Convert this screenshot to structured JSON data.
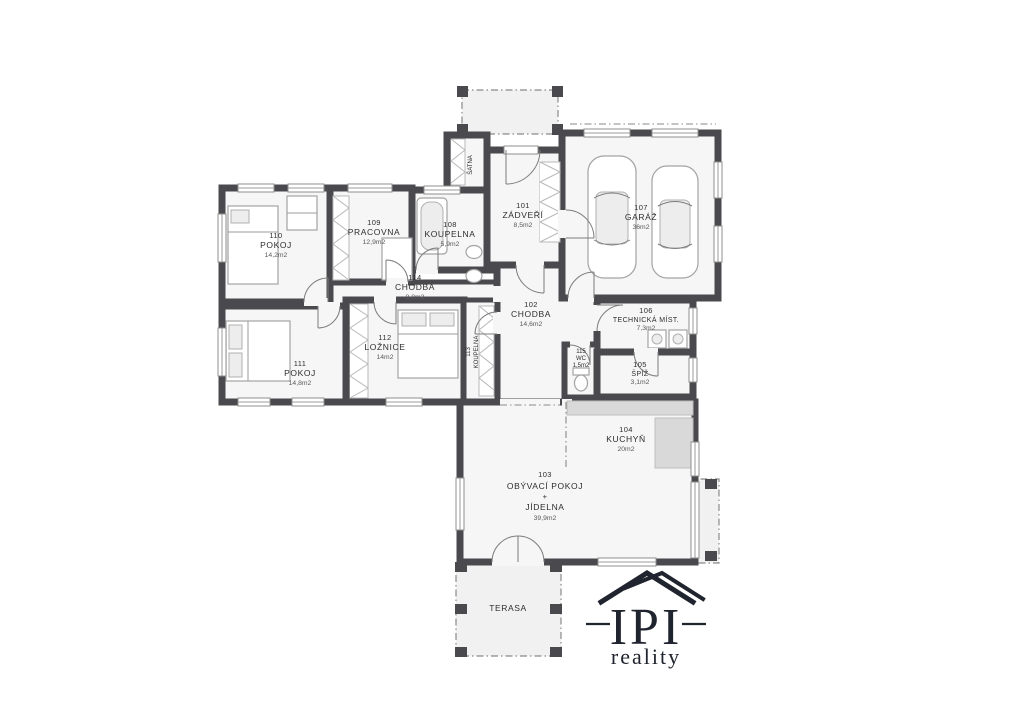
{
  "colors": {
    "wall": "#4a4a4e",
    "room_fill": "#f6f6f6",
    "label_text": "#2e2e2e",
    "logo": "#20242e"
  },
  "rooms": {
    "r101": {
      "number": "101",
      "name": "ZÁDVEŘÍ",
      "area": "8,5m2"
    },
    "r102": {
      "number": "102",
      "name": "CHODBA",
      "area": "14,6m2"
    },
    "r103": {
      "number": "103",
      "name": "OBÝVACÍ POKOJ",
      "plus": "+",
      "name2": "JÍDELNA",
      "area": "39,9m2"
    },
    "r104": {
      "number": "104",
      "name": "KUCHYŇ",
      "area": "20m2"
    },
    "r105": {
      "number": "105",
      "name": "ŠPÍŽ",
      "area": "3,1m2"
    },
    "r106": {
      "number": "106",
      "name": "TECHNICKÁ MÍST.",
      "area": "7,3m2"
    },
    "r107": {
      "number": "107",
      "name": "GARÁŽ",
      "area": "36m2"
    },
    "r108": {
      "number": "108",
      "name": "KOUPELNA",
      "area": "5,9m2"
    },
    "r109": {
      "number": "109",
      "name": "PRACOVNA",
      "area": "12,9m2"
    },
    "r110": {
      "number": "110",
      "name": "POKOJ",
      "area": "14,2m2"
    },
    "r111": {
      "number": "111",
      "name": "POKOJ",
      "area": "14,8m2"
    },
    "r112": {
      "number": "112",
      "name": "LOŽNICE",
      "area": "14m2"
    },
    "r113": {
      "number": "113",
      "name": "KOUPELNA"
    },
    "r114": {
      "number": "114",
      "name": "CHODBA",
      "area": "8,8m2"
    },
    "wc": {
      "number": "115",
      "name": "WC",
      "area": "1,5m2"
    },
    "satna": {
      "name": "ŠATNA"
    },
    "terasa": {
      "name": "TERASA"
    }
  },
  "logo": {
    "name": "IPI",
    "tagline": "reality"
  }
}
